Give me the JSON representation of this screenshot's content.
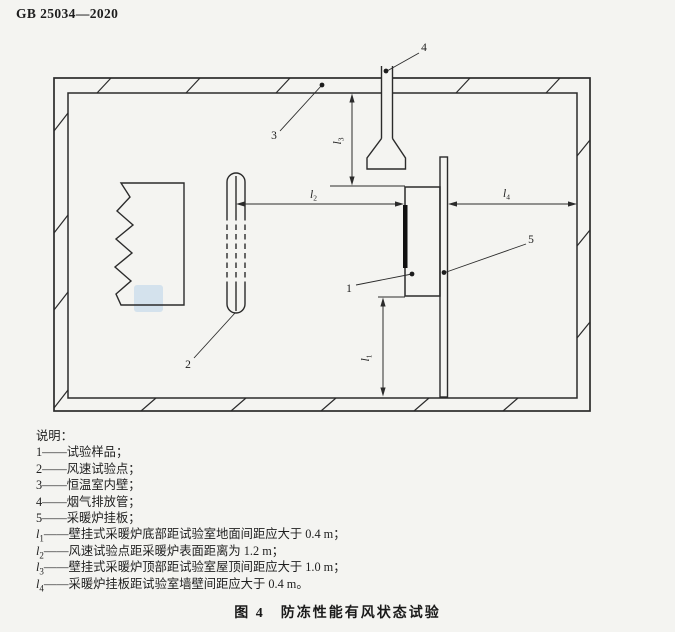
{
  "page": {
    "header": "GB 25034—2020",
    "caption": "图 4　防冻性能有风状态试验",
    "colors": {
      "background": "#f4f4f1",
      "line": "#2b2b2b",
      "text": "#222222",
      "watermark": "#b9d3ea"
    }
  },
  "diagram": {
    "labels": {
      "sample": "1",
      "wind_point": "2",
      "inner_wall": "3",
      "flue": "4",
      "board": "5"
    }
  },
  "legend": {
    "title": "说明：",
    "items": [
      {
        "num": "1",
        "desc": "——试验样品；"
      },
      {
        "num": "2",
        "desc": "——风速试验点；"
      },
      {
        "num": "3",
        "desc": "——恒温室内壁；"
      },
      {
        "num": "4",
        "desc": "——烟气排放管；"
      },
      {
        "num": "5",
        "desc": "——采暖炉挂板；"
      }
    ],
    "dims": [
      {
        "sym": "l",
        "sub": "1",
        "desc": "——壁挂式采暖炉底部距试验室地面间距应大于 0.4 m；"
      },
      {
        "sym": "l",
        "sub": "2",
        "desc": "——风速试验点距采暖炉表面距离为 1.2 m；"
      },
      {
        "sym": "l",
        "sub": "3",
        "desc": "——壁挂式采暖炉顶部距试验室屋顶间距应大于 1.0 m；"
      },
      {
        "sym": "l",
        "sub": "4",
        "desc": "——采暖炉挂板距试验室墙壁间距应大于 0.4 m。"
      }
    ]
  }
}
